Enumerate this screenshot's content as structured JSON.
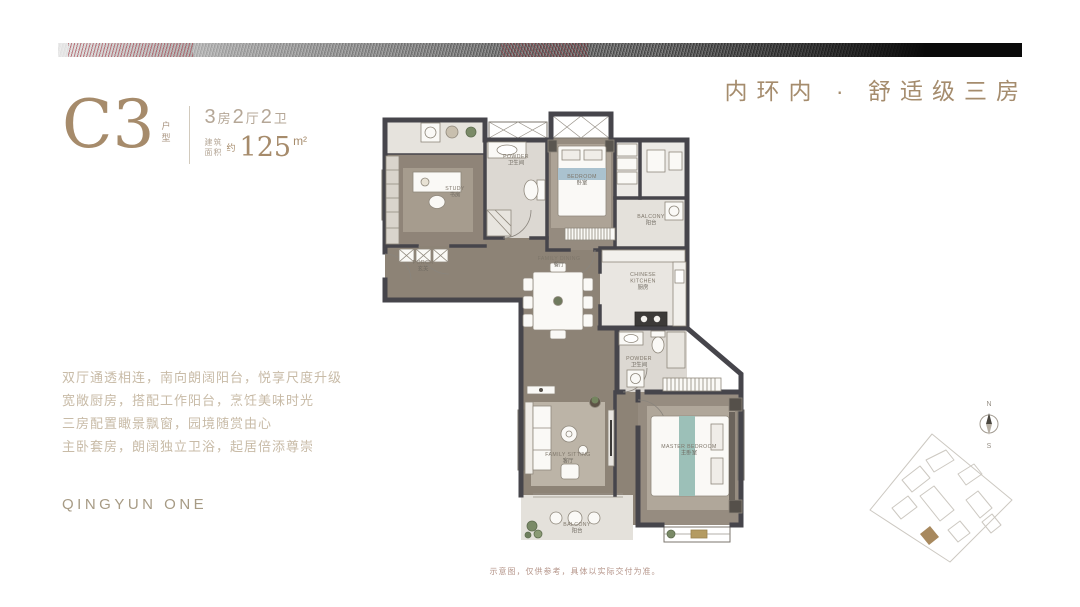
{
  "header": {
    "tagline": "内环内 · 舒适级三房"
  },
  "unit": {
    "code": "C3",
    "code_tag": "户型",
    "layout_parts": [
      "3",
      "房",
      "2",
      "厅",
      "2",
      "卫"
    ],
    "area_label_1": "建筑",
    "area_label_2": "面积",
    "area_approx": "约",
    "area_value": "125",
    "area_unit": "m²"
  },
  "features": [
    "双厅通透相连，南向朗阔阳台，悦享尺度升级",
    "宽敞厨房，搭配工作阳台，烹饪美味时光",
    "三房配置瞰景飘窗，园境随赏由心",
    "主卧套房，朗阔独立卫浴，起居倍添尊崇"
  ],
  "brand": "QINGYUN ONE",
  "floorplan": {
    "rooms": [
      {
        "en": "STUDY",
        "zh": "书房",
        "x": 100,
        "y": 80
      },
      {
        "en": "POWDER",
        "zh": "卫生间",
        "x": 161,
        "y": 48
      },
      {
        "en": "BEDROOM",
        "zh": "卧室",
        "x": 227,
        "y": 68
      },
      {
        "en": "BALCONY",
        "zh": "阳台",
        "x": 296,
        "y": 108
      },
      {
        "en": "CHINESE\nKITCHEN",
        "zh": "厨房",
        "x": 288,
        "y": 166
      },
      {
        "en": "FAMILY DINING",
        "zh": "餐厅",
        "x": 204,
        "y": 150
      },
      {
        "en": "PORCH",
        "zh": "玄关",
        "x": 68,
        "y": 154
      },
      {
        "en": "POWDER",
        "zh": "卫生间",
        "x": 284,
        "y": 250
      },
      {
        "en": "FAMILY SITTING",
        "zh": "客厅",
        "x": 213,
        "y": 346
      },
      {
        "en": "MASTER BEDROOM",
        "zh": "主卧室",
        "x": 334,
        "y": 338
      },
      {
        "en": "BALCONY",
        "zh": "阳台",
        "x": 222,
        "y": 416
      }
    ],
    "compass": {
      "north": "N",
      "south": "S"
    }
  },
  "disclaimer": "示意图，仅供参考，具体以实际交付为准。",
  "colors": {
    "accent_gold": "#a68b6b",
    "wall": "#46454b",
    "wood": "#8d8376",
    "tile": "#e3e0da",
    "teal_runner": "#9cc0b8",
    "blue_runner": "#aac2cf",
    "red_accent": "#96232a"
  }
}
